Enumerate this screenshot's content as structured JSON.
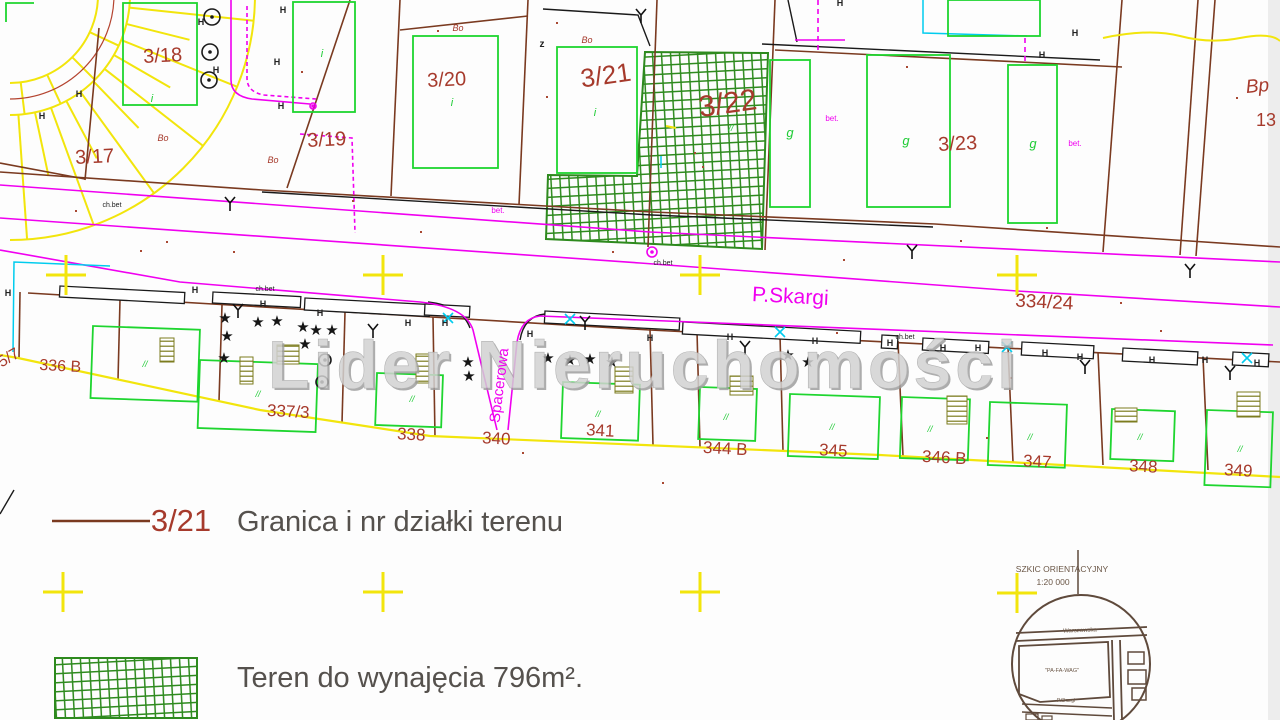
{
  "watermark": "Lider Nieruchomości",
  "legend": {
    "boundary_number": "3/21",
    "boundary_text": "Granica i nr działki terenu",
    "area_text": "Teren do wynajęcia 796m²."
  },
  "inset": {
    "title": "SZKIC ORIENTACYJNY",
    "scale": "1:20 000",
    "street_top": "Warszawska",
    "block_label": "\"PA-FA-WAG\"",
    "street_bottom": "P.Skargi"
  },
  "colors": {
    "boundary_brown": "#7a3a20",
    "label_red": "#a63a2c",
    "building_green": "#1ed52f",
    "hatch_green": "#2e8a1e",
    "street_magenta": "#f000f0",
    "survey_yellow": "#f2e50c",
    "utility_cyan": "#00ccee",
    "ink_black": "#222222",
    "legend_gray": "#55514d",
    "inset_brown": "#5f4a3c",
    "stairs_olive": "#7c7c1e",
    "watermark_gray": "#c9c9c9"
  },
  "map": {
    "labels": [
      {
        "t": "3/17",
        "x": 95,
        "y": 163,
        "s": 20,
        "c": "red",
        "r": -3
      },
      {
        "t": "3/18",
        "x": 163,
        "y": 62,
        "s": 20,
        "c": "red",
        "r": -3
      },
      {
        "t": "3/19",
        "x": 327,
        "y": 146,
        "s": 20,
        "c": "red",
        "r": -3
      },
      {
        "t": "3/20",
        "x": 447,
        "y": 86,
        "s": 20,
        "c": "red",
        "r": -3
      },
      {
        "t": "3/21",
        "x": 607,
        "y": 84,
        "s": 26,
        "c": "red",
        "r": -8
      },
      {
        "t": "3/22",
        "x": 729,
        "y": 113,
        "s": 30,
        "c": "red",
        "r": -8
      },
      {
        "t": "3/23",
        "x": 958,
        "y": 150,
        "s": 20,
        "c": "red",
        "r": -3
      },
      {
        "t": "334/24",
        "x": 1044,
        "y": 308,
        "s": 19,
        "c": "red",
        "r": 3
      },
      {
        "t": "5/7",
        "x": 11,
        "y": 362,
        "s": 16,
        "c": "red",
        "r": -30
      },
      {
        "t": "336 B",
        "x": 60,
        "y": 371,
        "s": 16,
        "c": "red",
        "r": 3
      },
      {
        "t": "337/3",
        "x": 288,
        "y": 417,
        "s": 17,
        "c": "red",
        "r": 3
      },
      {
        "t": "338",
        "x": 411,
        "y": 440,
        "s": 17,
        "c": "red",
        "r": 3
      },
      {
        "t": "340",
        "x": 496,
        "y": 444,
        "s": 17,
        "c": "red",
        "r": 3
      },
      {
        "t": "341",
        "x": 600,
        "y": 436,
        "s": 17,
        "c": "red",
        "r": 3
      },
      {
        "t": "344 B",
        "x": 725,
        "y": 454,
        "s": 17,
        "c": "red",
        "r": 3
      },
      {
        "t": "345",
        "x": 833,
        "y": 456,
        "s": 17,
        "c": "red",
        "r": 3
      },
      {
        "t": "346 B",
        "x": 944,
        "y": 463,
        "s": 17,
        "c": "red",
        "r": 3
      },
      {
        "t": "347",
        "x": 1037,
        "y": 467,
        "s": 17,
        "c": "red",
        "r": 3
      },
      {
        "t": "348",
        "x": 1143,
        "y": 472,
        "s": 17,
        "c": "red",
        "r": 3
      },
      {
        "t": "349",
        "x": 1238,
        "y": 476,
        "s": 17,
        "c": "red",
        "r": 3
      },
      {
        "t": "Bp",
        "x": 1258,
        "y": 92,
        "s": 19,
        "c": "red",
        "i": 1,
        "r": -5
      },
      {
        "t": "13",
        "x": 1266,
        "y": 126,
        "s": 18,
        "c": "red"
      },
      {
        "t": "P.Skargi",
        "x": 790,
        "y": 303,
        "s": 21,
        "c": "mag",
        "r": 3,
        "n": "street-label-pskargi"
      },
      {
        "t": "Spacerowa",
        "x": 504,
        "y": 386,
        "s": 15,
        "c": "mag",
        "r": -83,
        "n": "street-label-spacerowa"
      },
      {
        "t": "g",
        "x": 790,
        "y": 137,
        "s": 13,
        "c": "grn",
        "i": 1
      },
      {
        "t": "g",
        "x": 906,
        "y": 145,
        "s": 13,
        "c": "grn",
        "i": 1
      },
      {
        "t": "g",
        "x": 1033,
        "y": 148,
        "s": 13,
        "c": "grn",
        "i": 1
      },
      {
        "t": "Bo",
        "x": 163,
        "y": 141,
        "s": 9,
        "c": "red",
        "i": 1
      },
      {
        "t": "Bo",
        "x": 273,
        "y": 163,
        "s": 9,
        "c": "red",
        "i": 1
      },
      {
        "t": "Bo",
        "x": 458,
        "y": 31,
        "s": 9,
        "c": "red",
        "i": 1
      },
      {
        "t": "Bo",
        "x": 587,
        "y": 43,
        "s": 9,
        "c": "red",
        "i": 1
      },
      {
        "t": "bet.",
        "x": 498,
        "y": 213,
        "s": 8,
        "c": "mag"
      },
      {
        "t": "bet.",
        "x": 832,
        "y": 121,
        "s": 8,
        "c": "mag"
      },
      {
        "t": "bet.",
        "x": 1075,
        "y": 146,
        "s": 8,
        "c": "mag"
      },
      {
        "t": "ch.bet",
        "x": 112,
        "y": 207,
        "s": 7,
        "c": "blk"
      },
      {
        "t": "ch.bet",
        "x": 265,
        "y": 291,
        "s": 7,
        "c": "blk"
      },
      {
        "t": "ch.bet",
        "x": 663,
        "y": 265,
        "s": 7,
        "c": "blk"
      },
      {
        "t": "ch.bet",
        "x": 905,
        "y": 339,
        "s": 7,
        "c": "blk"
      },
      {
        "t": "z",
        "x": 542,
        "y": 47,
        "s": 10,
        "c": "blk",
        "b": 1
      },
      {
        "t": "i",
        "x": 152,
        "y": 102,
        "s": 11,
        "c": "grn",
        "i": 1
      },
      {
        "t": "i",
        "x": 322,
        "y": 57,
        "s": 11,
        "c": "grn",
        "i": 1
      },
      {
        "t": "i",
        "x": 452,
        "y": 106,
        "s": 11,
        "c": "grn",
        "i": 1
      },
      {
        "t": "i",
        "x": 595,
        "y": 116,
        "s": 11,
        "c": "grn",
        "i": 1
      },
      {
        "t": "//",
        "x": 145,
        "y": 367,
        "s": 9,
        "c": "grn",
        "i": 1
      },
      {
        "t": "//",
        "x": 258,
        "y": 397,
        "s": 9,
        "c": "grn",
        "i": 1
      },
      {
        "t": "//",
        "x": 412,
        "y": 402,
        "s": 9,
        "c": "grn",
        "i": 1
      },
      {
        "t": "//",
        "x": 598,
        "y": 417,
        "s": 9,
        "c": "grn",
        "i": 1
      },
      {
        "t": "//",
        "x": 726,
        "y": 420,
        "s": 9,
        "c": "grn",
        "i": 1
      },
      {
        "t": "//",
        "x": 832,
        "y": 430,
        "s": 9,
        "c": "grn",
        "i": 1
      },
      {
        "t": "//",
        "x": 930,
        "y": 432,
        "s": 9,
        "c": "grn",
        "i": 1
      },
      {
        "t": "//",
        "x": 1030,
        "y": 440,
        "s": 9,
        "c": "grn",
        "i": 1
      },
      {
        "t": "//",
        "x": 1140,
        "y": 440,
        "s": 9,
        "c": "grn",
        "i": 1
      },
      {
        "t": "//",
        "x": 1240,
        "y": 452,
        "s": 9,
        "c": "grn",
        "i": 1
      },
      {
        "t": "//",
        "x": 731,
        "y": 131,
        "s": 9,
        "c": "grn",
        "i": 1
      },
      {
        "t": "H",
        "x": 201,
        "y": 25,
        "s": 9,
        "c": "blk",
        "b": 1
      },
      {
        "t": "H",
        "x": 216,
        "y": 73,
        "s": 9,
        "c": "blk",
        "b": 1
      },
      {
        "t": "H",
        "x": 277,
        "y": 65,
        "s": 9,
        "c": "blk",
        "b": 1
      },
      {
        "t": "H",
        "x": 283,
        "y": 13,
        "s": 9,
        "c": "blk",
        "b": 1
      },
      {
        "t": "H",
        "x": 281,
        "y": 109,
        "s": 9,
        "c": "blk",
        "b": 1
      },
      {
        "t": "H",
        "x": 79,
        "y": 97,
        "s": 9,
        "c": "blk",
        "b": 1
      },
      {
        "t": "H",
        "x": 42,
        "y": 119,
        "s": 9,
        "c": "blk",
        "b": 1
      },
      {
        "t": "H",
        "x": 840,
        "y": 6,
        "s": 9,
        "c": "blk",
        "b": 1
      },
      {
        "t": "H",
        "x": 1075,
        "y": 36,
        "s": 9,
        "c": "blk",
        "b": 1
      },
      {
        "t": "H",
        "x": 1042,
        "y": 58,
        "s": 9,
        "c": "blk",
        "b": 1
      },
      {
        "t": "H",
        "x": 8,
        "y": 296,
        "s": 9,
        "c": "blk",
        "b": 1
      },
      {
        "t": "H",
        "x": 195,
        "y": 293,
        "s": 9,
        "c": "blk",
        "b": 1
      },
      {
        "t": "H",
        "x": 263,
        "y": 307,
        "s": 9,
        "c": "blk",
        "b": 1
      },
      {
        "t": "H",
        "x": 320,
        "y": 316,
        "s": 9,
        "c": "blk",
        "b": 1
      },
      {
        "t": "H",
        "x": 408,
        "y": 326,
        "s": 9,
        "c": "blk",
        "b": 1
      },
      {
        "t": "H",
        "x": 445,
        "y": 326,
        "s": 9,
        "c": "blk",
        "b": 1
      },
      {
        "t": "H",
        "x": 530,
        "y": 337,
        "s": 9,
        "c": "blk",
        "b": 1
      },
      {
        "t": "H",
        "x": 650,
        "y": 341,
        "s": 9,
        "c": "blk",
        "b": 1
      },
      {
        "t": "H",
        "x": 730,
        "y": 340,
        "s": 9,
        "c": "blk",
        "b": 1
      },
      {
        "t": "H",
        "x": 815,
        "y": 344,
        "s": 9,
        "c": "blk",
        "b": 1
      },
      {
        "t": "H",
        "x": 890,
        "y": 346,
        "s": 9,
        "c": "blk",
        "b": 1
      },
      {
        "t": "H",
        "x": 943,
        "y": 351,
        "s": 9,
        "c": "blk",
        "b": 1
      },
      {
        "t": "H",
        "x": 978,
        "y": 351,
        "s": 9,
        "c": "blk",
        "b": 1
      },
      {
        "t": "H",
        "x": 1045,
        "y": 356,
        "s": 9,
        "c": "blk",
        "b": 1
      },
      {
        "t": "H",
        "x": 1080,
        "y": 360,
        "s": 9,
        "c": "blk",
        "b": 1
      },
      {
        "t": "H",
        "x": 1152,
        "y": 363,
        "s": 9,
        "c": "blk",
        "b": 1
      },
      {
        "t": "H",
        "x": 1205,
        "y": 363,
        "s": 9,
        "c": "blk",
        "b": 1
      },
      {
        "t": "H",
        "x": 1257,
        "y": 366,
        "s": 9,
        "c": "blk",
        "b": 1
      }
    ],
    "survey_crosses": [
      [
        66,
        275
      ],
      [
        383,
        275
      ],
      [
        700,
        275
      ],
      [
        1017,
        275
      ],
      [
        63,
        592
      ],
      [
        383,
        592
      ],
      [
        700,
        592
      ],
      [
        1017,
        593
      ]
    ],
    "trees": [
      [
        225,
        318
      ],
      [
        227,
        336
      ],
      [
        258,
        322
      ],
      [
        277,
        321
      ],
      [
        303,
        327
      ],
      [
        316,
        330
      ],
      [
        332,
        330
      ],
      [
        305,
        344
      ],
      [
        224,
        358
      ],
      [
        468,
        362
      ],
      [
        469,
        376
      ],
      [
        548,
        358
      ],
      [
        570,
        360
      ],
      [
        590,
        359
      ],
      [
        612,
        362
      ],
      [
        788,
        355
      ],
      [
        808,
        362
      ]
    ],
    "wells": [
      {
        "x": 212,
        "y": 17,
        "r": 8
      },
      {
        "x": 210,
        "y": 52,
        "r": 8
      },
      {
        "x": 209,
        "y": 80,
        "r": 8
      },
      {
        "x": 325,
        "y": 360,
        "r": 6
      },
      {
        "x": 322,
        "y": 382,
        "r": 6
      },
      {
        "x": 652,
        "y": 252,
        "r": 5,
        "c": "mag"
      },
      {
        "x": 313,
        "y": 106,
        "r": 3,
        "c": "mag"
      }
    ],
    "gate_forks": [
      [
        230,
        203
      ],
      [
        641,
        15
      ],
      [
        912,
        251
      ],
      [
        1190,
        270
      ],
      [
        238,
        310
      ],
      [
        373,
        330
      ],
      [
        585,
        322
      ],
      [
        745,
        347
      ],
      [
        1085,
        366
      ],
      [
        1230,
        372
      ]
    ],
    "utility_x_marks": [
      [
        570,
        319
      ],
      [
        780,
        332
      ],
      [
        1007,
        347
      ],
      [
        1247,
        358
      ],
      [
        448,
        318
      ]
    ],
    "survey_dots": [
      [
        437,
        30
      ],
      [
        556,
        22
      ],
      [
        301,
        71
      ],
      [
        352,
        200
      ],
      [
        420,
        231
      ],
      [
        546,
        96
      ],
      [
        702,
        166
      ],
      [
        906,
        66
      ],
      [
        1010,
        377
      ],
      [
        1120,
        302
      ],
      [
        233,
        251
      ],
      [
        166,
        241
      ],
      [
        612,
        251
      ],
      [
        762,
        216
      ],
      [
        986,
        437
      ],
      [
        662,
        482
      ],
      [
        522,
        452
      ],
      [
        836,
        332
      ],
      [
        1046,
        227
      ],
      [
        1236,
        97
      ],
      [
        694,
        152
      ],
      [
        843,
        259
      ],
      [
        960,
        240
      ],
      [
        1160,
        330
      ],
      [
        75,
        210
      ],
      [
        140,
        250
      ]
    ],
    "buildings": [
      {
        "x": 123,
        "y": 3,
        "w": 74,
        "h": 102
      },
      {
        "x": 293,
        "y": 2,
        "w": 62,
        "h": 110
      },
      {
        "x": 413,
        "y": 36,
        "w": 85,
        "h": 132
      },
      {
        "x": 557,
        "y": 47,
        "w": 80,
        "h": 126
      },
      {
        "x": 948,
        "y": 0,
        "w": 92,
        "h": 36
      },
      {
        "x": 770,
        "y": 60,
        "w": 40,
        "h": 147
      },
      {
        "x": 867,
        "y": 55,
        "w": 83,
        "h": 152
      },
      {
        "x": 1008,
        "y": 65,
        "w": 49,
        "h": 158
      },
      {
        "x": 93,
        "y": 326,
        "w": 107,
        "h": 72,
        "r": 2
      },
      {
        "x": 200,
        "y": 360,
        "w": 118,
        "h": 68,
        "r": 2
      },
      {
        "x": 377,
        "y": 373,
        "w": 66,
        "h": 52,
        "r": 2
      },
      {
        "x": 563,
        "y": 382,
        "w": 77,
        "h": 56,
        "r": 2
      },
      {
        "x": 700,
        "y": 387,
        "w": 57,
        "h": 52,
        "r": 2
      },
      {
        "x": 790,
        "y": 394,
        "w": 90,
        "h": 62,
        "r": 2
      },
      {
        "x": 902,
        "y": 397,
        "w": 68,
        "h": 61,
        "r": 2
      },
      {
        "x": 990,
        "y": 402,
        "w": 77,
        "h": 63,
        "r": 2
      },
      {
        "x": 1112,
        "y": 409,
        "w": 63,
        "h": 50,
        "r": 2
      },
      {
        "x": 1207,
        "y": 410,
        "w": 66,
        "h": 75,
        "r": 2
      }
    ],
    "stairs": [
      {
        "x": 160,
        "y": 338,
        "w": 14,
        "h": 24
      },
      {
        "x": 240,
        "y": 357,
        "w": 13,
        "h": 27
      },
      {
        "x": 416,
        "y": 354,
        "w": 13,
        "h": 29
      },
      {
        "x": 615,
        "y": 367,
        "w": 18,
        "h": 26
      },
      {
        "x": 730,
        "y": 376,
        "w": 23,
        "h": 19
      },
      {
        "x": 947,
        "y": 396,
        "w": 20,
        "h": 28
      },
      {
        "x": 1115,
        "y": 408,
        "w": 22,
        "h": 14
      },
      {
        "x": 1237,
        "y": 392,
        "w": 23,
        "h": 25
      },
      {
        "x": 277,
        "y": 345,
        "w": 22,
        "h": 19
      }
    ]
  }
}
